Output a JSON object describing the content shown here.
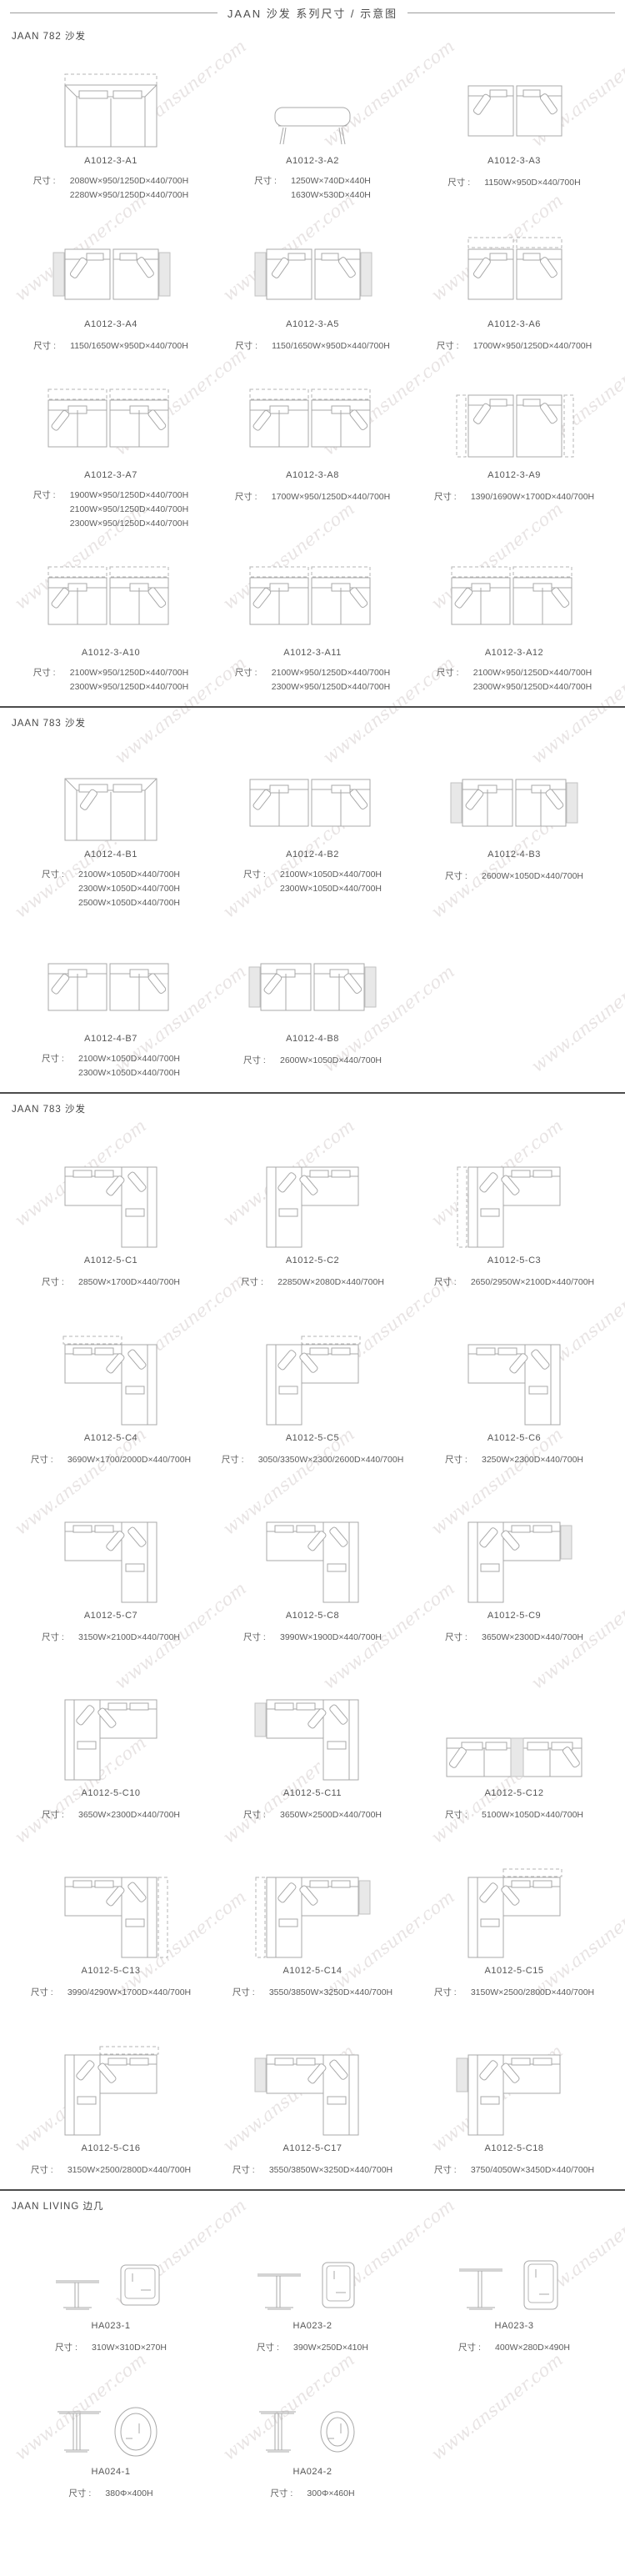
{
  "page": {
    "title": "JAAN  沙发 系列尺寸 / 示意图",
    "dim_prefix": "尺寸 : ",
    "watermark_text": "www.ansuner.com",
    "colors": {
      "line": "#a9a9a9",
      "dashed_line": "#b5b5b5",
      "shaded_panel": "#e8e8e8",
      "divider": "#4c4c4c",
      "text": "#595959"
    }
  },
  "sections": [
    {
      "title": "JAAN 782 沙发",
      "items": [
        {
          "model": "A1012-3-A1",
          "dims": [
            "2080W×950/1250D×440/700H",
            "2280W×950/1250D×440/700H"
          ],
          "figure": {
            "kind": "sofa-wide",
            "icon": "two-seat-sofa-plan-drawing",
            "dashTop": true
          }
        },
        {
          "model": "A1012-3-A2",
          "dims": [
            "1250W×740D×440H",
            "1630W×530D×440H"
          ],
          "figure": {
            "kind": "bench",
            "icon": "bench-side-view-drawing"
          }
        },
        {
          "model": "A1012-3-A3",
          "dims": [
            "1150W×950D×440/700H"
          ],
          "figure": {
            "kind": "pair-squares",
            "icon": "two-corner-chairs-plan-drawing"
          }
        },
        {
          "model": "A1012-3-A4",
          "dims": [
            "1150/1650W×950D×440/700H"
          ],
          "figure": {
            "kind": "pair-squares",
            "icon": "two-chairs-side-tables-plan-drawing",
            "gray": "outer"
          }
        },
        {
          "model": "A1012-3-A5",
          "dims": [
            "1150/1650W×950D×440/700H"
          ],
          "figure": {
            "kind": "pair-squares",
            "icon": "two-chairs-side-tables-plan-drawing",
            "gray": "outer"
          }
        },
        {
          "model": "A1012-3-A6",
          "dims": [
            "1700W×950/1250D×440/700H"
          ],
          "figure": {
            "kind": "pair-squares",
            "icon": "two-chaise-modules-plan-drawing",
            "dashTop": true
          }
        },
        {
          "model": "A1012-3-A7",
          "dims": [
            "1900W×950/1250D×440/700H",
            "2100W×950/1250D×440/700H",
            "2300W×950/1250D×440/700H"
          ],
          "figure": {
            "kind": "pair-wide",
            "icon": "two-sofa-modules-plan-drawing",
            "dashTop": true
          }
        },
        {
          "model": "A1012-3-A8",
          "dims": [
            "1700W×950/1250D×440/700H"
          ],
          "figure": {
            "kind": "pair-wide",
            "icon": "two-sofa-modules-plan-drawing",
            "dashTop": true
          }
        },
        {
          "model": "A1012-3-A9",
          "dims": [
            "1390/1690W×1700D×440/700H"
          ],
          "figure": {
            "kind": "pair-squares",
            "icon": "two-tall-modules-plan-drawing",
            "dashSides": true,
            "tall": true
          }
        },
        {
          "model": "A1012-3-A10",
          "dims": [
            "2100W×950/1250D×440/700H",
            "2300W×950/1250D×440/700H"
          ],
          "figure": {
            "kind": "pair-wide",
            "icon": "two-sofa-modules-plan-drawing",
            "dashTop": true
          }
        },
        {
          "model": "A1012-3-A11",
          "dims": [
            "2100W×950/1250D×440/700H",
            "2300W×950/1250D×440/700H"
          ],
          "figure": {
            "kind": "pair-wide",
            "icon": "two-sofa-modules-plan-drawing",
            "dashTop": true
          }
        },
        {
          "model": "A1012-3-A12",
          "dims": [
            "2100W×950/1250D×440/700H",
            "2300W×950/1250D×440/700H"
          ],
          "figure": {
            "kind": "pair-wide",
            "icon": "two-sofa-modules-plan-drawing",
            "dashTop": true
          }
        }
      ]
    },
    {
      "title": "JAAN 783 沙发",
      "items": [
        {
          "model": "A1012-4-B1",
          "dims": [
            "2100W×1050D×440/700H",
            "2300W×1050D×440/700H",
            "2500W×1050D×440/700H"
          ],
          "figure": {
            "kind": "sofa-wide",
            "icon": "two-seat-sofa-plan-drawing",
            "pillow": true
          }
        },
        {
          "model": "A1012-4-B2",
          "dims": [
            "2100W×1050D×440/700H",
            "2300W×1050D×440/700H"
          ],
          "figure": {
            "kind": "pair-wide",
            "icon": "two-sofa-modules-plan-drawing"
          }
        },
        {
          "model": "A1012-4-B3",
          "dims": [
            "2600W×1050D×440/700H"
          ],
          "figure": {
            "kind": "pair-wide",
            "icon": "two-sofa-modules-side-panels-plan-drawing",
            "gray": "outer"
          }
        },
        {
          "model": "A1012-4-B7",
          "dims": [
            "2100W×1050D×440/700H",
            "2300W×1050D×440/700H"
          ],
          "figure": {
            "kind": "pair-wide",
            "icon": "two-sofa-modules-plan-drawing"
          }
        },
        {
          "model": "A1012-4-B8",
          "dims": [
            "2600W×1050D×440/700H"
          ],
          "figure": {
            "kind": "pair-wide",
            "icon": "two-sofa-modules-side-panels-plan-drawing",
            "gray": "outer"
          }
        }
      ]
    },
    {
      "title": "JAAN 783 沙发",
      "items": [
        {
          "model": "A1012-5-C1",
          "dims": [
            "2850W×1700D×440/700H"
          ],
          "figure": {
            "kind": "l-shape",
            "icon": "l-sectional-plan-drawing",
            "v": "right"
          }
        },
        {
          "model": "A1012-5-C2",
          "dims": [
            "22850W×2080D×440/700H"
          ],
          "figure": {
            "kind": "l-shape",
            "icon": "l-sectional-plan-drawing",
            "v": "left"
          }
        },
        {
          "model": "A1012-5-C3",
          "dims": [
            "2650/2950W×2100D×440/700H"
          ],
          "figure": {
            "kind": "l-shape",
            "icon": "l-sectional-plan-drawing",
            "v": "left",
            "dash": "left"
          }
        },
        {
          "model": "A1012-5-C4",
          "dims": [
            "3690W×1700/2000D×440/700H"
          ],
          "figure": {
            "kind": "l-shape",
            "icon": "l-sectional-plan-drawing",
            "v": "right",
            "dash": "top"
          }
        },
        {
          "model": "A1012-5-C5",
          "dims": [
            "3050/3350W×2300/2600D×440/700H"
          ],
          "figure": {
            "kind": "l-shape",
            "icon": "l-sectional-plan-drawing",
            "v": "left",
            "dash": "top"
          }
        },
        {
          "model": "A1012-5-C6",
          "dims": [
            "3250W×2300D×440/700H"
          ],
          "figure": {
            "kind": "l-shape",
            "icon": "l-sectional-plan-drawing",
            "v": "right"
          }
        },
        {
          "model": "A1012-5-C7",
          "dims": [
            "3150W×2100D×440/700H"
          ],
          "figure": {
            "kind": "l-shape",
            "icon": "l-sectional-plan-drawing",
            "v": "right"
          }
        },
        {
          "model": "A1012-5-C8",
          "dims": [
            "3990W×1900D×440/700H"
          ],
          "figure": {
            "kind": "l-shape",
            "icon": "l-sectional-plan-drawing",
            "v": "right",
            "gray": "mid"
          }
        },
        {
          "model": "A1012-5-C9",
          "dims": [
            "3650W×2300D×440/700H"
          ],
          "figure": {
            "kind": "l-shape",
            "icon": "l-sectional-plan-drawing",
            "v": "left",
            "gray": "right"
          }
        },
        {
          "model": "A1012-5-C10",
          "dims": [
            "3650W×2300D×440/700H"
          ],
          "figure": {
            "kind": "l-shape",
            "icon": "l-sectional-plan-drawing",
            "v": "left",
            "gray": "mid"
          }
        },
        {
          "model": "A1012-5-C11",
          "dims": [
            "3650W×2500D×440/700H"
          ],
          "figure": {
            "kind": "l-shape",
            "icon": "l-sectional-plan-drawing",
            "v": "right",
            "gray": "left"
          }
        },
        {
          "model": "A1012-5-C12",
          "dims": [
            "5100W×1050D×440/700H"
          ],
          "figure": {
            "kind": "sofa-long",
            "icon": "four-seat-sofa-plan-drawing"
          }
        },
        {
          "model": "A1012-5-C13",
          "dims": [
            "3990/4290W×1700D×440/700H"
          ],
          "figure": {
            "kind": "l-shape",
            "icon": "l-sectional-plan-drawing",
            "v": "right",
            "gray": "mid",
            "dash": "right"
          }
        },
        {
          "model": "A1012-5-C14",
          "dims": [
            "3550/3850W×3250D×440/700H"
          ],
          "figure": {
            "kind": "l-shape",
            "icon": "l-sectional-plan-drawing",
            "v": "left",
            "gray": "right",
            "dash": "left"
          }
        },
        {
          "model": "A1012-5-C15",
          "dims": [
            "3150W×2500/2800D×440/700H"
          ],
          "figure": {
            "kind": "l-shape",
            "icon": "l-sectional-plan-drawing",
            "v": "left",
            "dash": "top"
          }
        },
        {
          "model": "A1012-5-C16",
          "dims": [
            "3150W×2500/2800D×440/700H"
          ],
          "figure": {
            "kind": "l-shape",
            "icon": "l-sectional-plan-drawing",
            "v": "left",
            "dash": "top"
          }
        },
        {
          "model": "A1012-5-C17",
          "dims": [
            "3550/3850W×3250D×440/700H"
          ],
          "figure": {
            "kind": "l-shape",
            "icon": "l-sectional-plan-drawing",
            "v": "right",
            "gray": "left"
          }
        },
        {
          "model": "A1012-5-C18",
          "dims": [
            "3750/4050W×3450D×440/700H"
          ],
          "figure": {
            "kind": "l-shape",
            "icon": "l-sectional-plan-drawing",
            "v": "left",
            "gray": "left"
          }
        }
      ]
    },
    {
      "title": "JAAN LIVING 边几",
      "items": [
        {
          "model": "HA023-1",
          "dims": [
            "310W×310D×270H"
          ],
          "figure": {
            "kind": "table-square",
            "icon": "side-table-square-drawing",
            "size": 0
          }
        },
        {
          "model": "HA023-2",
          "dims": [
            "390W×250D×410H"
          ],
          "figure": {
            "kind": "table-square",
            "icon": "side-table-square-drawing",
            "size": 1
          }
        },
        {
          "model": "HA023-3",
          "dims": [
            "400W×280D×490H"
          ],
          "figure": {
            "kind": "table-square",
            "icon": "side-table-square-drawing",
            "size": 2
          }
        },
        {
          "model": "HA024-1",
          "dims": [
            "380Φ×400H"
          ],
          "figure": {
            "kind": "table-round",
            "icon": "side-table-round-drawing",
            "size": 0
          }
        },
        {
          "model": "HA024-2",
          "dims": [
            "300Φ×460H"
          ],
          "figure": {
            "kind": "table-round",
            "icon": "side-table-round-drawing",
            "size": 1
          }
        }
      ]
    }
  ]
}
